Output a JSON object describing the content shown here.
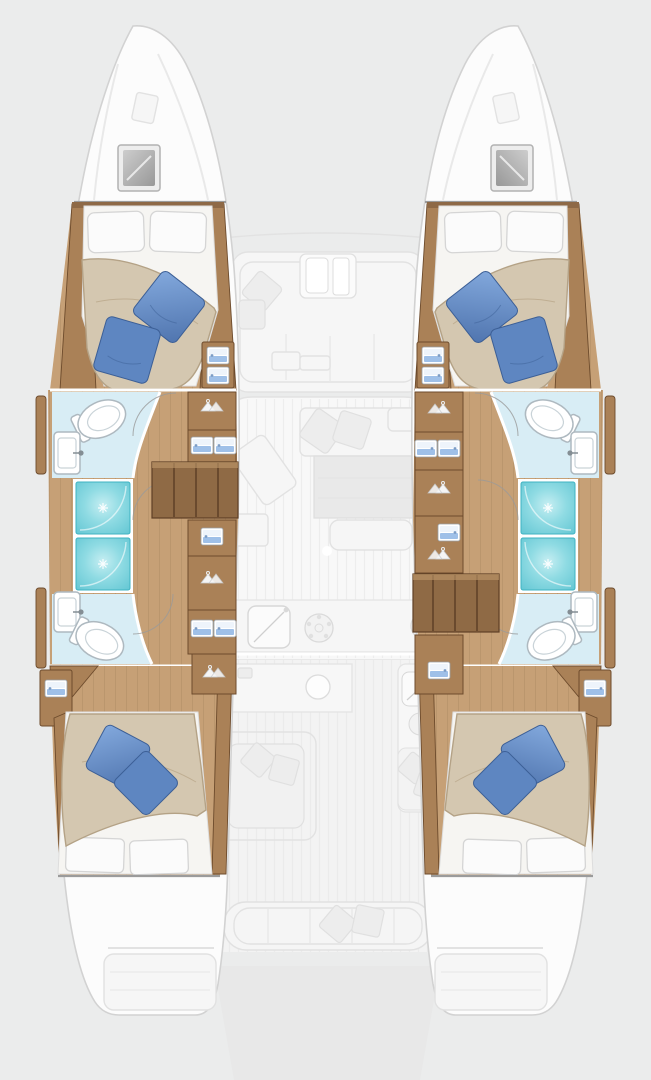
{
  "diagram": {
    "kind": "yacht-floor-plan",
    "vessel_type": "sailing-catamaran",
    "view": "overhead deck plan, bow up",
    "highlighted_zone": "hull accommodation (cabins and bathrooms)",
    "faded_zone": "central saloon, foredeck lounge, aft cockpit, swim platforms"
  },
  "colors": {
    "bg": "#ebecec",
    "hullFill": "#fcfcfc",
    "hullStroke": "#d2d2d2",
    "woodFloor": "#c6a076",
    "woodCab": "#aa8157",
    "woodTrim": "#8e6946",
    "woodDark": "#6d4b2c",
    "stairWood": "#8f6a45",
    "duvet": "#d4c7b0",
    "duvetEdge": "#b4a286",
    "pillowWhite": "#fbfbfb",
    "bpMid": "#5e86c1",
    "bpDark": "#3c5f96",
    "tealDark": "#3fb3c2",
    "bathFloor": "#d8edf5",
    "fixWhite": "#ffffff",
    "fixStroke": "#aeb9c0",
    "drawerBlue": "#9fc0e8",
    "fadedFill": "#f6f6f6",
    "fadedStroke": "#e2e2e2"
  },
  "hulls": [
    {
      "side": "port (left)",
      "rooms": [
        {
          "name": "forward cabin",
          "features": [
            "double berth",
            "2 white pillows",
            "2 blue accent pillows",
            "wardrobe drawers",
            "overhead deck hatch"
          ]
        },
        {
          "name": "forward bathroom",
          "features": [
            "toilet",
            "washbasin",
            "door swing"
          ]
        },
        {
          "name": "shower compartments",
          "count": 2
        },
        {
          "name": "aft bathroom",
          "features": [
            "toilet",
            "washbasin",
            "door swing"
          ]
        },
        {
          "name": "companionway stairs",
          "position": "midship, forward of center"
        },
        {
          "name": "hallway wardrobes",
          "features": [
            "hanging lockers",
            "drawer units"
          ]
        },
        {
          "name": "aft cabin",
          "features": [
            "double berth",
            "2 white pillows",
            "2 blue accent pillows",
            "side shelf"
          ]
        }
      ]
    },
    {
      "side": "starboard (right)",
      "rooms": [
        {
          "name": "forward cabin",
          "features": [
            "double berth",
            "2 white pillows",
            "2 blue accent pillows",
            "wardrobe drawers",
            "overhead deck hatch"
          ]
        },
        {
          "name": "forward bathroom",
          "features": [
            "toilet",
            "washbasin",
            "door swing"
          ]
        },
        {
          "name": "shower compartments",
          "count": 2
        },
        {
          "name": "aft bathroom",
          "features": [
            "toilet",
            "washbasin",
            "door swing"
          ]
        },
        {
          "name": "companionway stairs",
          "position": "midship, aft of center"
        },
        {
          "name": "hallway wardrobes",
          "features": [
            "hanging lockers",
            "drawer units"
          ]
        },
        {
          "name": "aft cabin",
          "features": [
            "double berth",
            "2 white pillows",
            "2 blue accent pillows",
            "side shelf"
          ]
        }
      ]
    }
  ],
  "center_deck": {
    "foredeck": [
      "forward cockpit lounge",
      "folding cockpit door",
      "scatter cushion",
      "bench seating"
    ],
    "saloon": [
      "sofa with cushions",
      "dining table",
      "bench",
      "lounge chair",
      "chart seat",
      "galley counter",
      "galley sink",
      "stove burners"
    ],
    "aft_cockpit": [
      "serving counter with sink",
      "cockpit table with seating",
      "wet bar with sink and burner",
      "bench with cushions",
      "aft bench with 2 cushions"
    ],
    "stern": [
      "port swim platform",
      "starboard swim platform",
      "tender platform"
    ]
  },
  "totals": {
    "cabins": 4,
    "toilets": 4,
    "washbasins": 4,
    "showers": 4,
    "berths": 4
  }
}
